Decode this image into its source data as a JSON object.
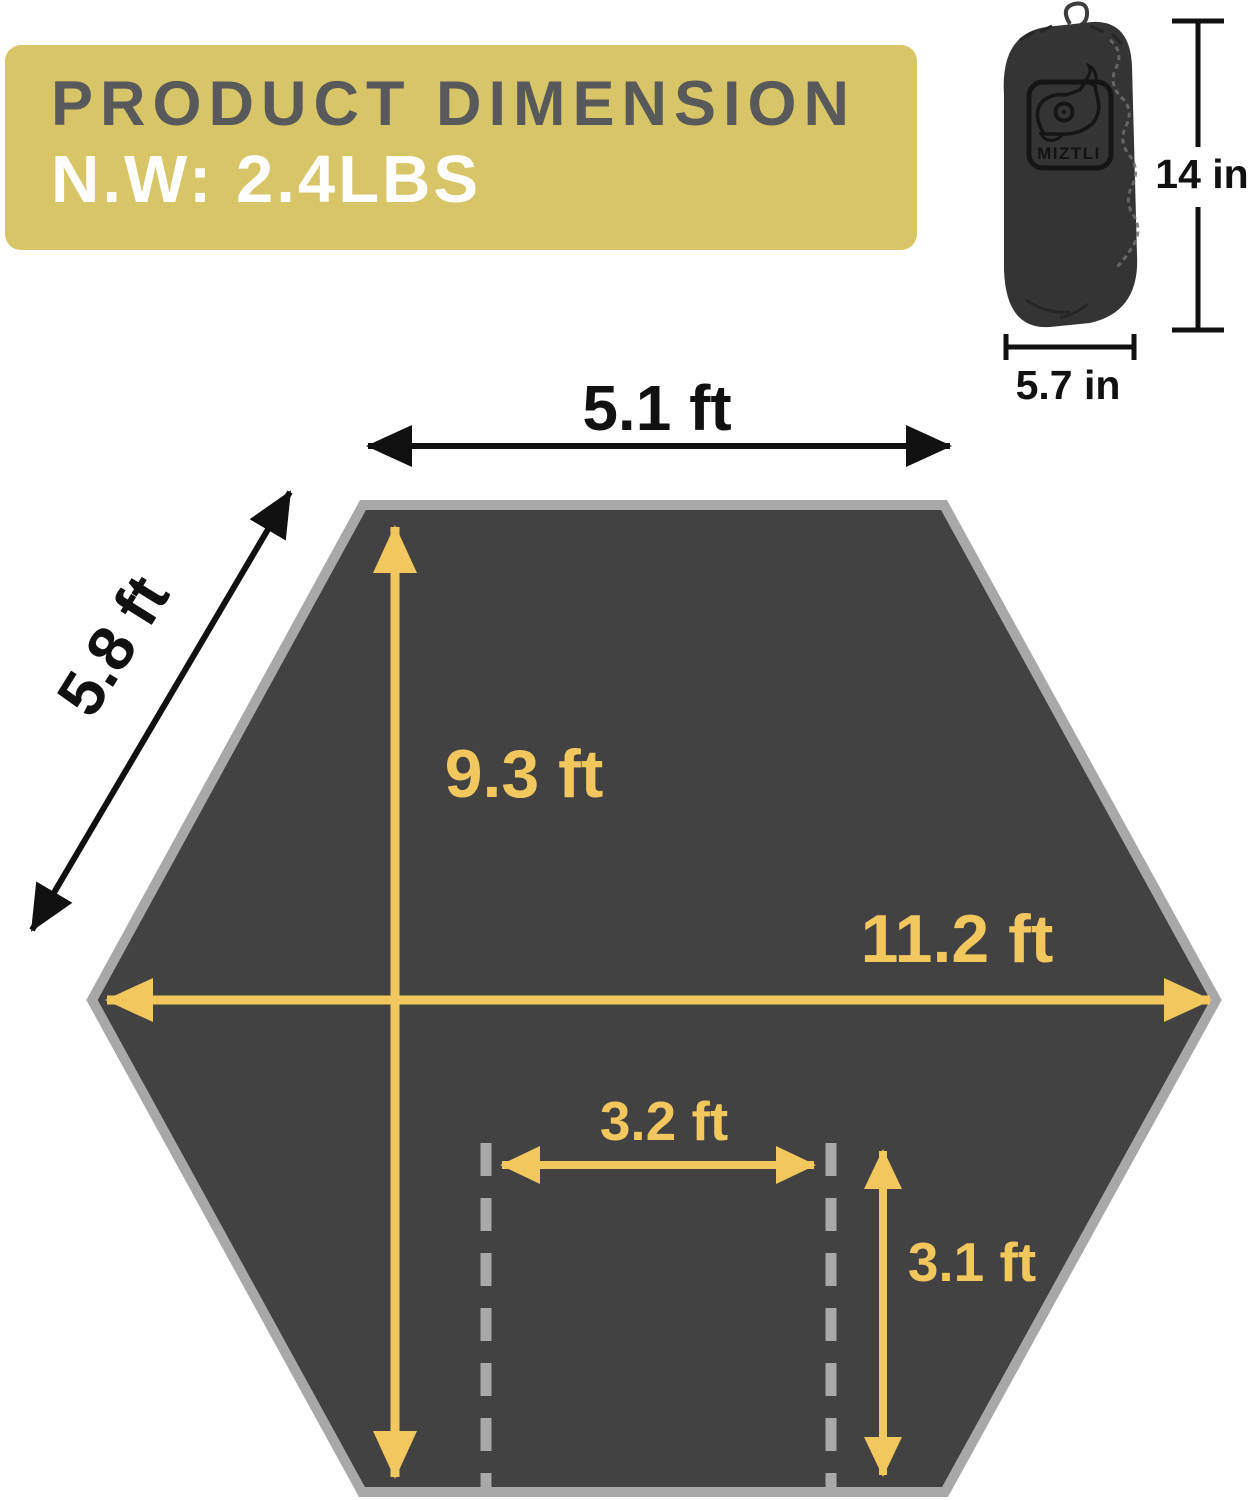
{
  "banner": {
    "title": "PRODUCT DIMENSION",
    "net_weight": "N.W: 2.4LBS"
  },
  "stuff_sack": {
    "brand": "MIZTLI",
    "height_label": "14 in",
    "width_label": "5.7 in"
  },
  "tarp": {
    "top_edge_label": "5.1 ft",
    "side_edge_label": "5.8 ft",
    "center_height_label": "9.3 ft",
    "max_width_label": "11.2 ft",
    "inner_width_label": "3.2 ft",
    "inner_height_label": "3.1 ft"
  },
  "colors": {
    "banner_bg": "#D8C567",
    "banner_title": "#58595B",
    "banner_weight": "#FFFFFF",
    "accent_yellow": "#F2C75E",
    "hexagon_fill": "#424242",
    "hexagon_border": "#A8A8A8",
    "dashed_gray": "#A9A9A9",
    "measure_black": "#111111",
    "bag_fill": "#343434"
  }
}
